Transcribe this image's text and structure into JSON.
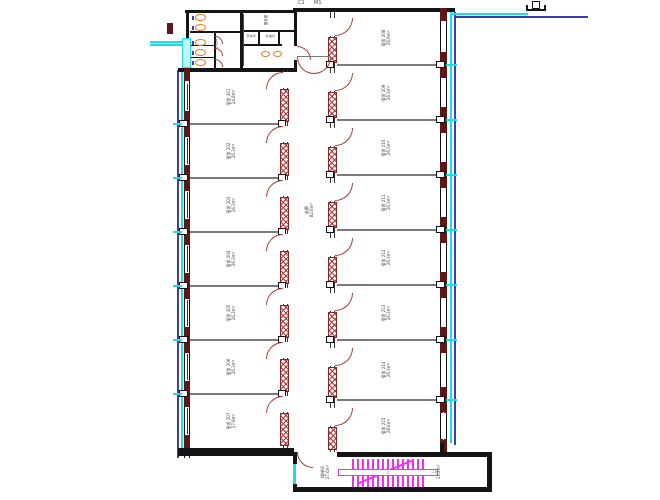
{
  "axis_tags": {
    "left": "C1",
    "right": "M1"
  },
  "corridor": {
    "name": "走廊",
    "area": "82.6m²"
  },
  "left_rooms": [
    {
      "name": "宿舍",
      "no": "201",
      "area": "24.8m²"
    },
    {
      "name": "宿舍",
      "no": "202",
      "area": "26.3m²"
    },
    {
      "name": "宿舍",
      "no": "203",
      "area": "26.3m²"
    },
    {
      "name": "宿舍",
      "no": "204",
      "area": "26.3m²"
    },
    {
      "name": "宿舍",
      "no": "205",
      "area": "26.3m²"
    },
    {
      "name": "宿舍",
      "no": "206",
      "area": "26.3m²"
    },
    {
      "name": "宿舍",
      "no": "207",
      "area": "27.8m²"
    }
  ],
  "right_rooms": [
    {
      "name": "宿舍",
      "no": "208",
      "area": "26.9m²"
    },
    {
      "name": "宿舍",
      "no": "209",
      "area": "26.3m²"
    },
    {
      "name": "宿舍",
      "no": "210",
      "area": "26.3m²"
    },
    {
      "name": "宿舍",
      "no": "211",
      "area": "26.3m²"
    },
    {
      "name": "宿舍",
      "no": "212",
      "area": "26.3m²"
    },
    {
      "name": "宿舍",
      "no": "213",
      "area": "26.3m²"
    },
    {
      "name": "宿舍",
      "no": "214",
      "area": "26.3m²"
    },
    {
      "name": "宿舍",
      "no": "215",
      "area": "28.6m²"
    }
  ],
  "toilet_block": {
    "wc_room": "卫生间",
    "wash_room": "盥洗室",
    "water_room": "开水间",
    "clean_room": "清洁间"
  },
  "stair": {
    "name": "楼梯间",
    "area": "27.6m²",
    "landing_area": "13.2m²",
    "up_label": "上"
  },
  "colors": {
    "wall": "#151515",
    "divider": "#7a7a7a",
    "hatch": "#b23434",
    "door": "#a63c34",
    "masonry": "#5e1616",
    "pipe_cyan": "#19dfe8",
    "pipe_blue": "#3c3cb4",
    "stair": "#f32cf3",
    "fixture": "#e07818"
  }
}
